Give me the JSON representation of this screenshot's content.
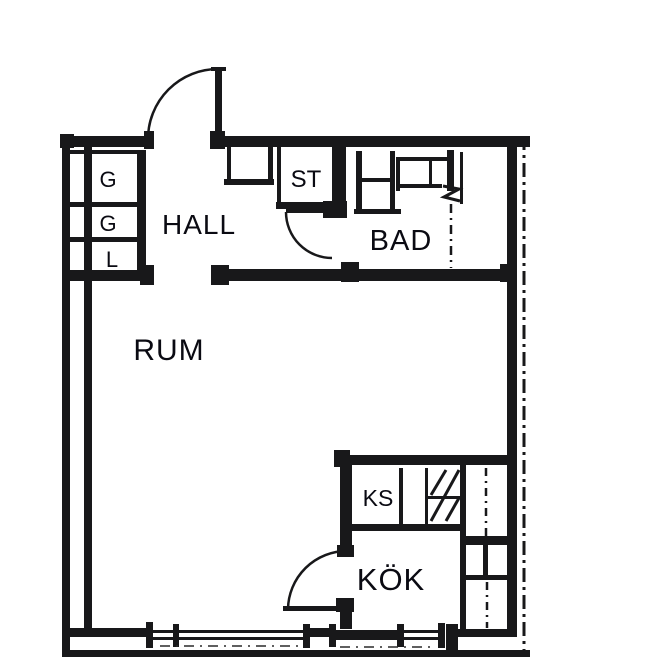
{
  "title": "Apartment floor plan",
  "colors": {
    "background": "#ffffff",
    "lines": "#18181a",
    "text": "#0a0a12"
  },
  "floor_plan": {
    "rooms": {
      "hall": {
        "label": "HALL"
      },
      "bad": {
        "label": "BAD"
      },
      "rum": {
        "label": "RUM"
      },
      "kok": {
        "label": "KÖK"
      }
    },
    "storage": {
      "g1": {
        "label": "G"
      },
      "g2": {
        "label": "G"
      },
      "l": {
        "label": "L"
      },
      "st": {
        "label": "ST"
      },
      "ks": {
        "label": "KS"
      }
    }
  }
}
